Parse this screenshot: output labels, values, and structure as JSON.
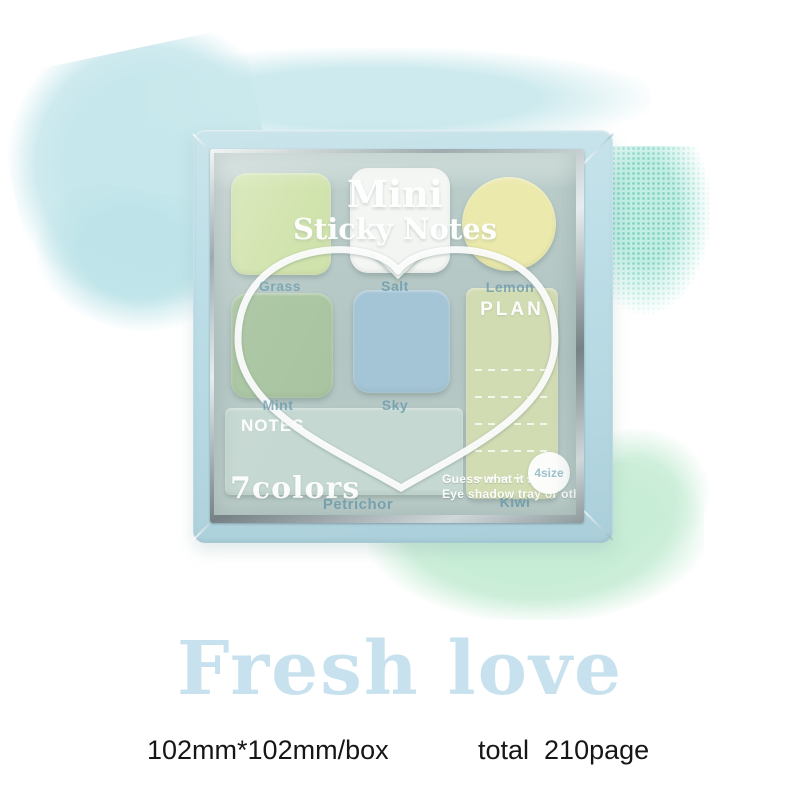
{
  "product_box": {
    "overlay_title": {
      "line1": "Mini",
      "line2": "Sticky Notes"
    },
    "pads": {
      "grass": {
        "label": "Grass",
        "color": "#cfe2a9"
      },
      "salt": {
        "label": "Salt",
        "color": "#f4f6f3"
      },
      "lemon": {
        "label": "Lemon",
        "color": "#ebe9ab"
      },
      "mint": {
        "label": "Mint",
        "color": "#a8c4a0"
      },
      "sky": {
        "label": "Sky",
        "color": "#a4c5d6"
      },
      "plan": {
        "title": "PLAN",
        "label": "Kiwi",
        "color": "#d2dcb3"
      },
      "notes": {
        "title": "NOTES",
        "subtitle": "7colors",
        "label": "Petrichor",
        "color": "#c5d8d1"
      }
    },
    "size_badge": "4size",
    "guess_caption": {
      "line1": "Guess what it is ?",
      "line2": "Eye shadow tray or others"
    },
    "colors": {
      "frame": "#bedfe8",
      "metal": "#cfd7d9",
      "tray": "#b2c5c2",
      "heart_band": "#ffffff",
      "glass_label_text": "#6898ac"
    }
  },
  "caption": {
    "title": "Fresh love",
    "title_color": "#c7e2ee",
    "spec_size": "102mm*102mm/box",
    "spec_pages": "total  210page"
  },
  "background": {
    "smear_cyan": "#c6e7ec",
    "smear_mint": "#c8edd6",
    "speckle_teal": "#60c4b0"
  }
}
